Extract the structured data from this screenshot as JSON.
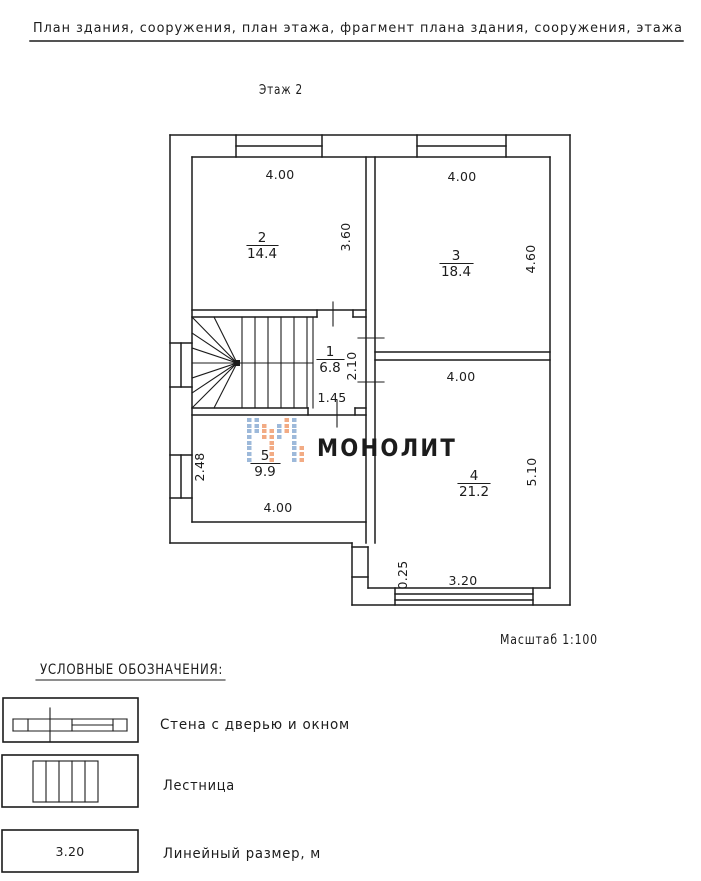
{
  "header": {
    "title": "План здания, сооружения, план этажа, фрагмент плана здания, сооружения, этажа"
  },
  "plan": {
    "floor_title": "Этаж 2",
    "scale_label": "Масштаб 1:100",
    "rooms": [
      {
        "number": "2",
        "area": "14.4"
      },
      {
        "number": "3",
        "area": "18.4"
      },
      {
        "number": "1",
        "area": "6.8"
      },
      {
        "number": "4",
        "area": "21.2"
      },
      {
        "number": "5",
        "area": "9.9"
      }
    ],
    "dimensions": {
      "room2_width": "4.00",
      "room3_width": "4.00",
      "room2_depth": "3.60",
      "room3_depth": "4.60",
      "hall_depth": "2.10",
      "hall_width": "1.45",
      "room4_width": "4.00",
      "room5_depth": "2.48",
      "room5_width": "4.00",
      "room4_depth": "5.10",
      "ledge": "0.25",
      "window_width": "3.20"
    }
  },
  "watermark": {
    "text": "МОНОЛИТ"
  },
  "legend": {
    "heading": "УСЛОВНЫЕ ОБОЗНАЧЕНИЯ:",
    "items": [
      {
        "label": "Стена с дверью и окном"
      },
      {
        "label": "Лестница"
      },
      {
        "label": "Линейный размер, м",
        "sample": "3.20"
      }
    ]
  },
  "colors": {
    "line": "#1c1c1c",
    "watermark_text": "#b6c0d4",
    "logo_blue": "#9db9da",
    "logo_orange": "#f2ab84"
  }
}
